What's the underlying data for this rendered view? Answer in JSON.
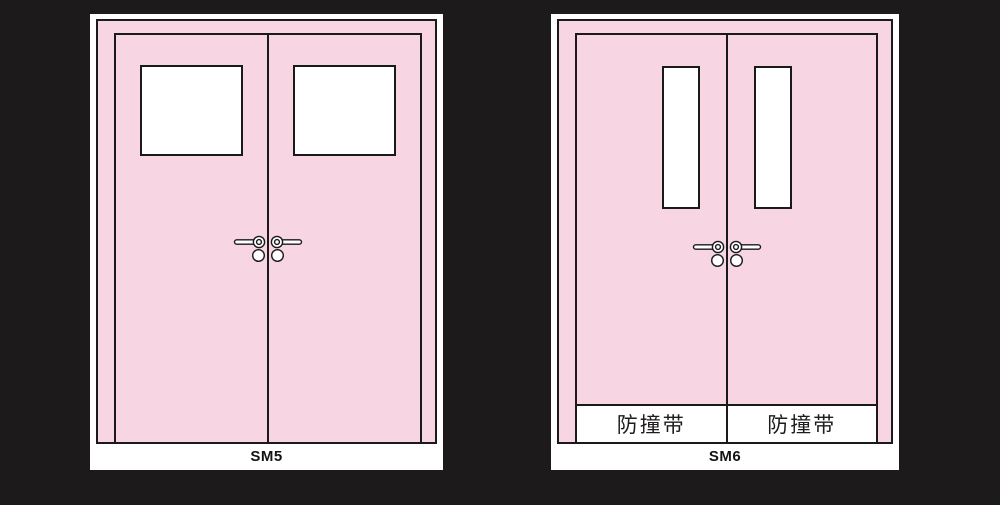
{
  "colors": {
    "background": "#1D1A1B",
    "door_pink": "#F8D5E3",
    "outline": "#1A1A1A",
    "panel_white": "#FFFFFF"
  },
  "figures": [
    {
      "label": "SM5",
      "strips": []
    },
    {
      "label": "SM6",
      "strips": [
        "防撞带",
        "防撞带"
      ]
    }
  ]
}
